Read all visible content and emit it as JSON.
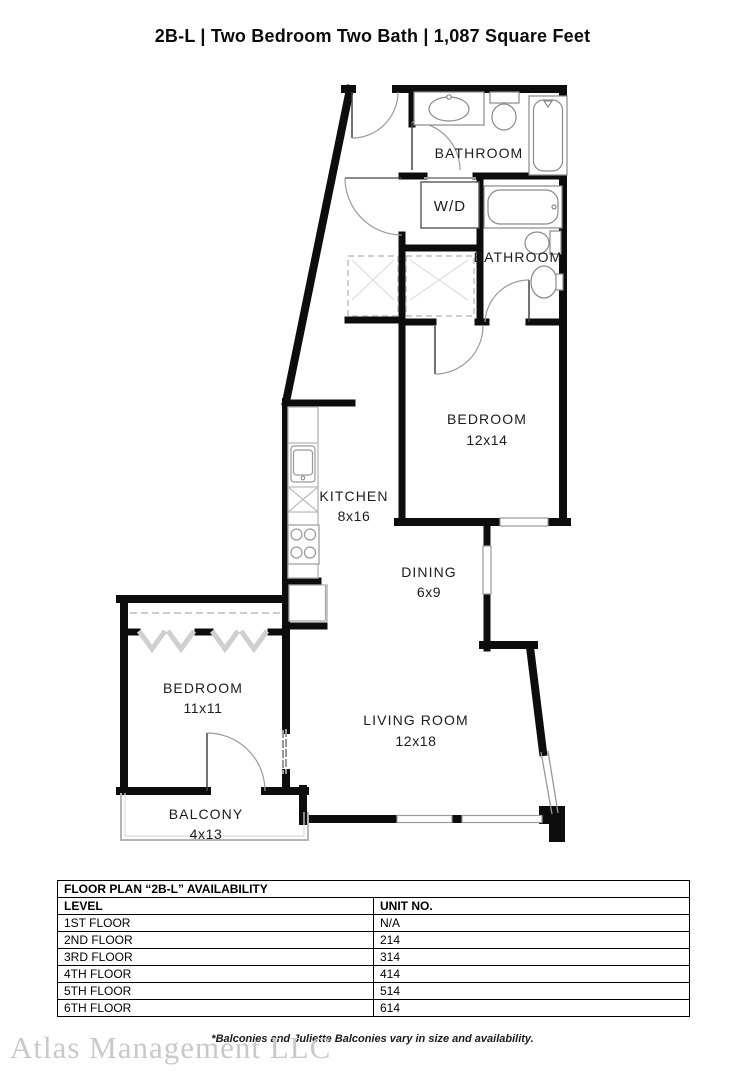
{
  "header": {
    "title": "2B-L | Two Bedroom Two Bath | 1,087  Square Feet"
  },
  "plan": {
    "rooms": {
      "bathroom1": {
        "label": "BATHROOM"
      },
      "wd": {
        "label": "W/D"
      },
      "bathroom2": {
        "label": "BATHROOM"
      },
      "bedroom1": {
        "label": "BEDROOM",
        "dims": "12x14"
      },
      "kitchen": {
        "label": "KITCHEN",
        "dims": "8x16"
      },
      "dining": {
        "label": "DINING",
        "dims": "6x9"
      },
      "bedroom2": {
        "label": "BEDROOM",
        "dims": "11x11"
      },
      "living": {
        "label": "LIVING ROOM",
        "dims": "12x18"
      },
      "balcony": {
        "label": "BALCONY",
        "dims": "4x13"
      }
    },
    "colors": {
      "wall": "#0d0d0d",
      "fixture": "#8a8a8a",
      "window": "#999999"
    }
  },
  "availability_table": {
    "title": "FLOOR PLAN “2B-L” AVAILABILITY",
    "columns": {
      "level": "LEVEL",
      "unit": "UNIT NO."
    },
    "rows": [
      {
        "level": "1ST FLOOR",
        "unit": "N/A"
      },
      {
        "level": "2ND FLOOR",
        "unit": "214"
      },
      {
        "level": "3RD FLOOR",
        "unit": "314"
      },
      {
        "level": "4TH FLOOR",
        "unit": "414"
      },
      {
        "level": "5TH FLOOR",
        "unit": "514"
      },
      {
        "level": "6TH FLOOR",
        "unit": "614"
      }
    ]
  },
  "footer": {
    "disclaimer": "*Balconies and Juliette Balconies vary in size and availability.",
    "company": "Atlas Management LLC"
  }
}
